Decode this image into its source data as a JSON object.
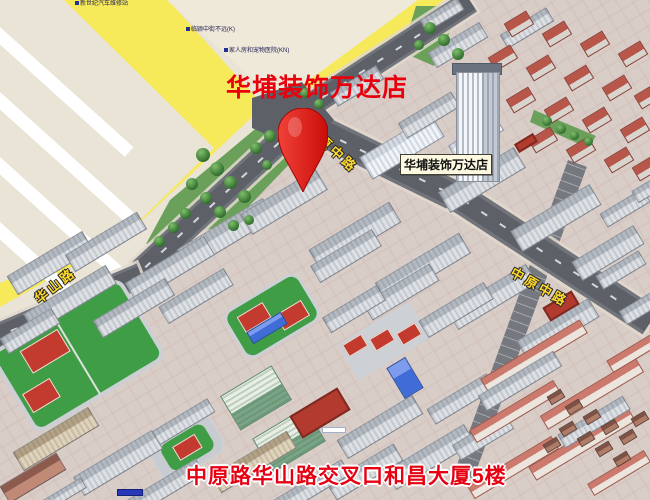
{
  "title_overlay": "华埔装饰万达店",
  "marker": {
    "label": "华埔装饰万达店"
  },
  "caption": "中原路华山路交叉口和昌大厦5楼",
  "roads": {
    "huashan_label": "华山路",
    "yuanzhong_label": "原中路",
    "zhongyuan_label": "中原中路"
  },
  "poi_labels": [
    {
      "text": "新世纪汽车维修站"
    },
    {
      "text": "临颍中街不远(K)"
    },
    {
      "text": "家人房和宠物医院(KN)"
    }
  ],
  "colors": {
    "title_red": "#e8000d",
    "caption_red": "#e60012",
    "pin_red": "#e11510",
    "road_label_yellow": "#ffd928",
    "highway_yellow": "#f6e95a",
    "field_green": "#3f9d45",
    "court_red": "#c23b2e"
  }
}
